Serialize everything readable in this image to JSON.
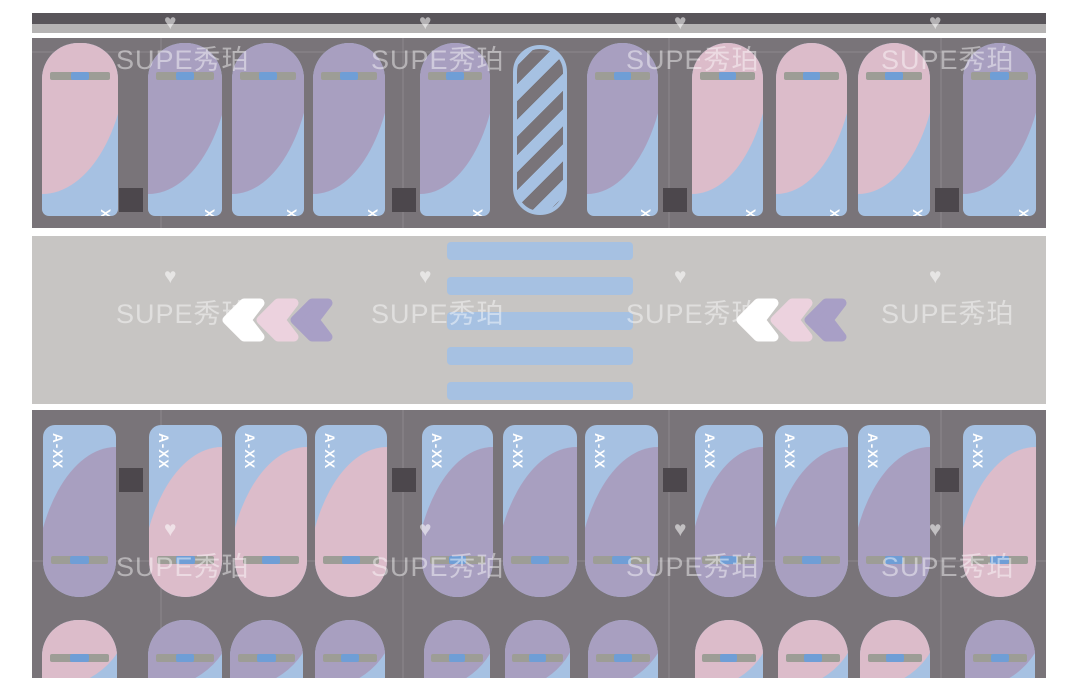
{
  "app": {
    "type": "parking-garage-floorplan",
    "watermark_text": "SUPE秀珀",
    "heart_icon": "♥",
    "stall_label_placeholder": "A-XX"
  },
  "palette": {
    "pink": "#dcbcca",
    "purple": "#a89fc0",
    "blue": "#a6c1e2",
    "lot_gray": "#797479",
    "road_gray": "#c7c5c3",
    "pillar_dark": "#4c474c",
    "wall_dark": "#59555a",
    "wall_light": "#b5b3b3",
    "bar_gray": "#9d9d96",
    "bar_blue": "#6f9ed6",
    "label_white": "#ffffff"
  },
  "parking": {
    "pillar_columns_x": [
      119,
      392,
      663,
      935
    ],
    "top_row": {
      "stalls": [
        {
          "type": "standard",
          "label": "A-XX",
          "color": "pink",
          "x": 42,
          "w": 76
        },
        {
          "type": "standard",
          "label": "A-XX",
          "color": "purple",
          "x": 148,
          "w": 74
        },
        {
          "type": "standard",
          "label": "A-XX",
          "color": "purple",
          "x": 232,
          "w": 72
        },
        {
          "type": "standard",
          "label": "A-XX",
          "color": "purple",
          "x": 313,
          "w": 72
        },
        {
          "type": "standard",
          "label": "A-XX",
          "color": "purple",
          "x": 420,
          "w": 70
        },
        {
          "type": "no-parking-hatched",
          "x": 513,
          "w": 54
        },
        {
          "type": "standard",
          "label": "A-XX",
          "color": "purple",
          "x": 587,
          "w": 71
        },
        {
          "type": "standard",
          "label": "A-XX",
          "color": "pink",
          "x": 692,
          "w": 71
        },
        {
          "type": "standard",
          "label": "A-XX",
          "color": "pink",
          "x": 776,
          "w": 71
        },
        {
          "type": "standard",
          "label": "A-XX",
          "color": "pink",
          "x": 858,
          "w": 72
        },
        {
          "type": "standard",
          "label": "A-XX",
          "color": "purple",
          "x": 963,
          "w": 73
        }
      ]
    },
    "bottom_row_main": {
      "stalls": [
        {
          "type": "standard",
          "label": "A-XX",
          "color": "purple",
          "x": 43,
          "w": 73
        },
        {
          "type": "standard",
          "label": "A-XX",
          "color": "pink",
          "x": 149,
          "w": 73
        },
        {
          "type": "standard",
          "label": "A-XX",
          "color": "pink",
          "x": 235,
          "w": 72
        },
        {
          "type": "standard",
          "label": "A-XX",
          "color": "pink",
          "x": 315,
          "w": 72
        },
        {
          "type": "standard",
          "label": "A-XX",
          "color": "purple",
          "x": 422,
          "w": 71
        },
        {
          "type": "standard",
          "label": "A-XX",
          "color": "purple",
          "x": 503,
          "w": 74
        },
        {
          "type": "standard",
          "label": "A-XX",
          "color": "purple",
          "x": 585,
          "w": 73
        },
        {
          "type": "standard",
          "label": "A-XX",
          "color": "purple",
          "x": 695,
          "w": 68
        },
        {
          "type": "standard",
          "label": "A-XX",
          "color": "purple",
          "x": 775,
          "w": 73
        },
        {
          "type": "standard",
          "label": "A-XX",
          "color": "purple",
          "x": 858,
          "w": 72
        },
        {
          "type": "standard",
          "label": "A-XX",
          "color": "pink",
          "x": 963,
          "w": 73
        }
      ]
    },
    "bottom_row_partial": {
      "stalls": [
        {
          "type": "standard",
          "color": "pink",
          "x": 42,
          "w": 75
        },
        {
          "type": "standard",
          "color": "purple",
          "x": 148,
          "w": 74
        },
        {
          "type": "standard",
          "color": "purple",
          "x": 230,
          "w": 73
        },
        {
          "type": "standard",
          "color": "purple",
          "x": 315,
          "w": 70
        },
        {
          "type": "standard",
          "color": "purple",
          "x": 424,
          "w": 66
        },
        {
          "type": "standard",
          "color": "purple",
          "x": 505,
          "w": 65
        },
        {
          "type": "standard",
          "color": "purple",
          "x": 588,
          "w": 70
        },
        {
          "type": "standard",
          "color": "pink",
          "x": 695,
          "w": 68
        },
        {
          "type": "standard",
          "color": "pink",
          "x": 778,
          "w": 70
        },
        {
          "type": "standard",
          "color": "pink",
          "x": 860,
          "w": 70
        },
        {
          "type": "standard",
          "color": "purple",
          "x": 965,
          "w": 70
        }
      ]
    }
  },
  "road": {
    "crosswalk": {
      "stripe_count": 5,
      "x": 447,
      "w": 186
    },
    "arrow_groups": [
      {
        "x": 219,
        "y": 298
      },
      {
        "x": 733,
        "y": 298
      }
    ],
    "arrows": [
      {
        "color": "#ffffff",
        "dx": 0,
        "z": 3
      },
      {
        "color": "#ecd2de",
        "dx": 34,
        "z": 1
      },
      {
        "color": "#a89fc6",
        "dx": 68,
        "z": 2
      }
    ]
  },
  "watermark_grid": {
    "columns_x": [
      116,
      371,
      626,
      881
    ],
    "rows_y": [
      38,
      292,
      545
    ]
  }
}
